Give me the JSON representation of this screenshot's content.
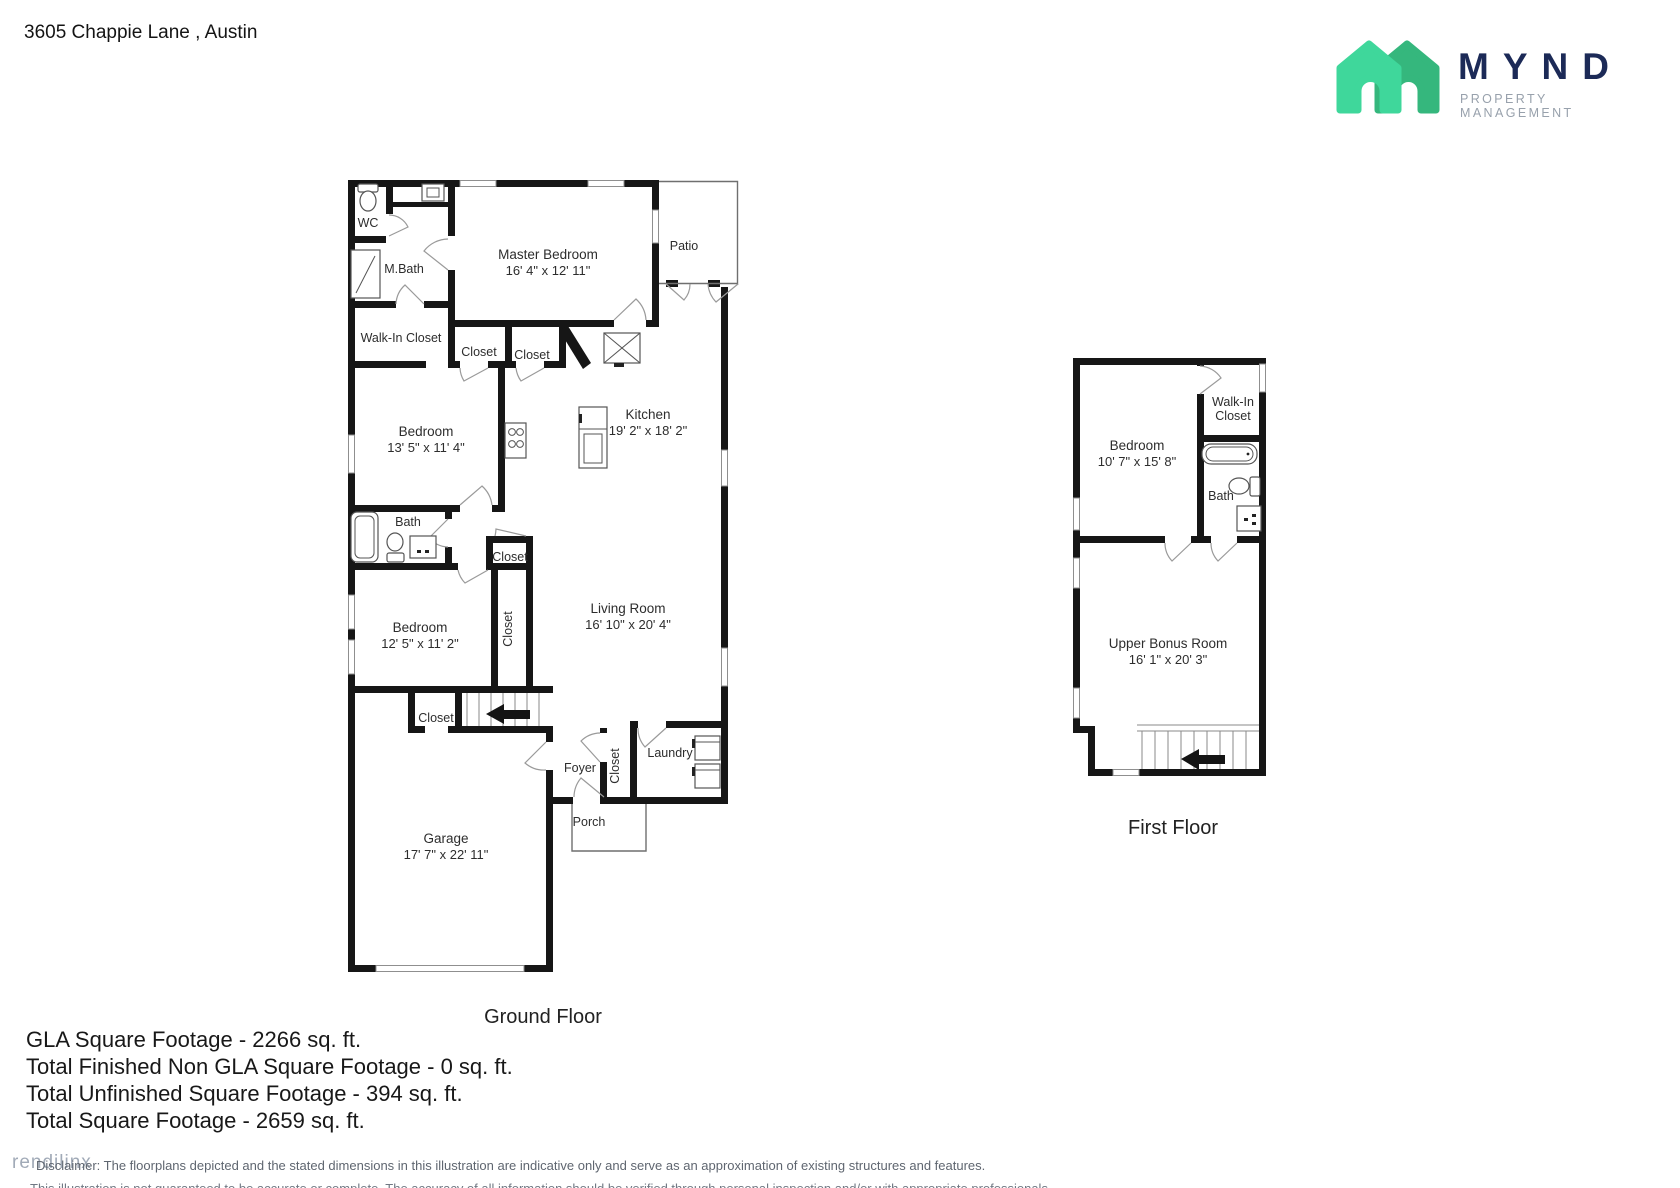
{
  "header": {
    "address": "3605 Chappie Lane , Austin",
    "logo": {
      "brand": "MYND",
      "tagline": "PROPERTY MANAGEMENT",
      "brand_color": "#1c2a57",
      "tagline_color": "#98a1ac",
      "house_front_green": "#3fd79b",
      "house_back_green": "#35b77d"
    }
  },
  "ground": {
    "title": "Ground Floor",
    "wc": "WC",
    "mbath": "M.Bath",
    "walk_in_closet": "Walk-In Closet",
    "master": {
      "name": "Master Bedroom",
      "dims": "16' 4\" x 12' 11\""
    },
    "patio": "Patio",
    "closet1": "Closet",
    "closet2": "Closet",
    "kitchen": {
      "name": "Kitchen",
      "dims": "19' 2\" x 18' 2\""
    },
    "bedroom2": {
      "name": "Bedroom",
      "dims": "13' 5\" x 11' 4\""
    },
    "bath": "Bath",
    "closet3": "Closet",
    "closet4": "Closet",
    "bedroom3": {
      "name": "Bedroom",
      "dims": "12' 5\" x 11' 2\""
    },
    "living": {
      "name": "Living Room",
      "dims": "16' 10\" x 20' 4\""
    },
    "closet5": "Closet",
    "foyer": "Foyer",
    "closet6": "Closet",
    "laundry": "Laundry",
    "porch": "Porch",
    "garage": {
      "name": "Garage",
      "dims": "17' 7\" x 22' 11\""
    }
  },
  "first": {
    "title": "First Floor",
    "bedroom": {
      "name": "Bedroom",
      "dims": "10' 7\" x 15' 8\""
    },
    "walk_in_line1": "Walk-In",
    "walk_in_line2": "Closet",
    "bath": "Bath",
    "bonus": {
      "name": "Upper Bonus Room",
      "dims": "16' 1\" x 20' 3\""
    }
  },
  "summary": {
    "line1": "GLA Square Footage - 2266 sq. ft.",
    "line2": "Total Finished Non GLA Square Footage - 0 sq. ft.",
    "line3": "Total Unfinished Square Footage - 394 sq. ft.",
    "line4": "Total Square Footage - 2659 sq. ft."
  },
  "footer": {
    "watermark": "rendilinx",
    "disclaimer_line1": "Disclaimer: The floorplans depicted and the stated dimensions in this illustration are indicative only and serve as an approximation of existing structures and features.",
    "disclaimer_line2": "This illustration is not guaranteed to be accurate or complete. The accuracy of all information should be verified through personal inspection and/or with appropriate professionals."
  }
}
